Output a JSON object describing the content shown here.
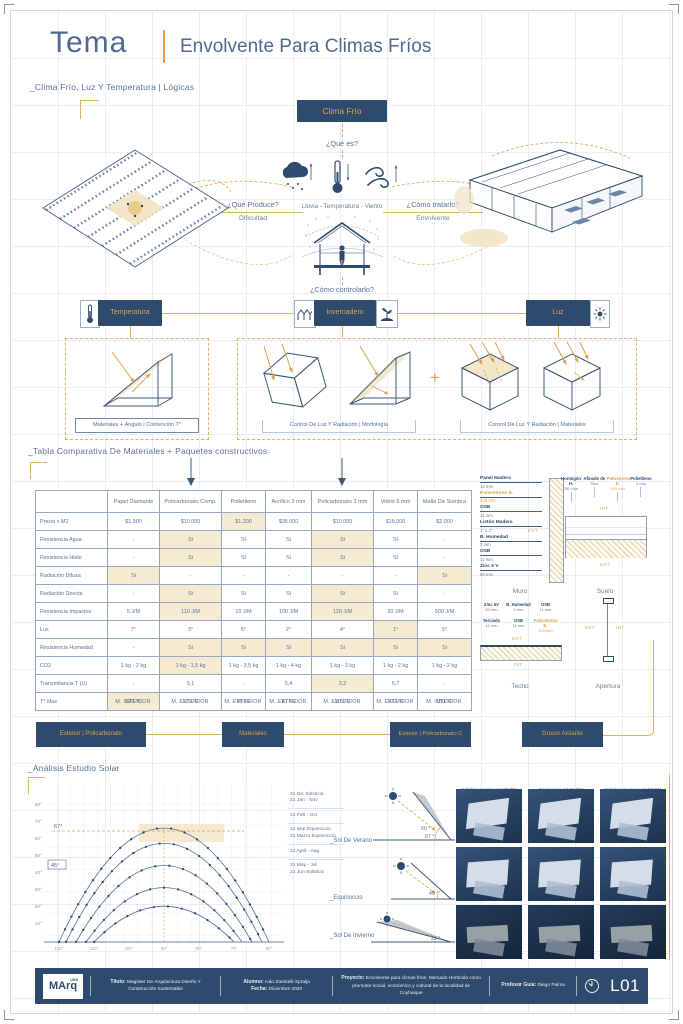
{
  "page": {
    "title_label": "Tema",
    "title": "Envolvente Para Climas Fríos"
  },
  "logic": {
    "section_label": "_Clima Frío, Luz Y Temperatura | Lógicas",
    "root_box": "Clima Frío",
    "q_what": "¿Qué es?",
    "elements_caption": "Lluvia   -   Temperatura   -   Viento",
    "q_produce": "¿Qué Produce?",
    "a_produce": "Dificultad",
    "q_treat": "¿Cómo tratarlo?",
    "a_treat": "Envolvente",
    "q_control": "¿Cómo controlarlo?",
    "control_temperatura": "Temperatura",
    "control_invernadero": "Invernadero",
    "control_luz": "Luz",
    "strategy_1": "Materiales + Ángulo | Contención T°",
    "strategy_2": "Control De Luz Y Radiación | Morfología",
    "strategy_3": "Control De Luz Y Radiación | Materiales",
    "plus": "+"
  },
  "table": {
    "section_label": "_Tabla Comparativa De Materiales + Paquetes constructivos",
    "columns": [
      "",
      "Papel Diamante",
      "Policarbonato Comp.",
      "Polietileno",
      "Acrílico 3 mm",
      "Policarbonato 3 mm",
      "Vidrio 6 mm",
      "Malla De Sombra"
    ],
    "rows": [
      {
        "label": "Precio x M2",
        "values": [
          "$1.500",
          "$10.000",
          "$1.200",
          "$35.000",
          "$10.000",
          "$15.000",
          "$2.000"
        ],
        "hl": [
          2
        ]
      },
      {
        "label": "Resistencia Agua",
        "values": [
          "-",
          "Si",
          "Si",
          "Si",
          "Si",
          "Si",
          "-"
        ],
        "hl": [
          1,
          4
        ]
      },
      {
        "label": "Resistencia Hielo",
        "values": [
          "-",
          "Si",
          "Si",
          "Si",
          "Si",
          "Si",
          "-"
        ],
        "hl": [
          1,
          4
        ]
      },
      {
        "label": "Radiación Difusa",
        "values": [
          "Si",
          "-",
          "-",
          "-",
          "-",
          "-",
          "Si"
        ],
        "hl": [
          0,
          6
        ]
      },
      {
        "label": "Radiación Directa",
        "values": [
          "-",
          "Si",
          "Si",
          "Si",
          "Si",
          "Si",
          "-"
        ],
        "hl": [
          1,
          4
        ]
      },
      {
        "label": "Resistencia Impactos",
        "values": [
          "5 J/M",
          "110 J/M",
          "10 J/M",
          "100 J/M",
          "120 J/M",
          "20 J/M",
          "500 J/M"
        ],
        "hl": [
          1,
          4
        ]
      },
      {
        "label": "Lux",
        "values": [
          "7°",
          "3°",
          "6°",
          "2°",
          "4°",
          "1°",
          "5°"
        ],
        "hl": [
          5
        ]
      },
      {
        "label": "Resistencia Humedad",
        "values": [
          "-",
          "Si",
          "Si",
          "Si",
          "Si",
          "Si",
          "Si"
        ],
        "hl": [
          1,
          2,
          3,
          4,
          5,
          6
        ]
      },
      {
        "label": "CO2",
        "values": [
          "1 kg - 2 kg",
          "1 kg - 1,5 kg",
          "1 kg - 3,5 kg",
          "1 kg - 4 kg",
          "1 kg - 3 kg",
          "1 kg - 2 kg",
          "1 kg - 2 kg"
        ],
        "hl": [
          1
        ]
      },
      {
        "label": "Transmitancia T (U)",
        "values": [
          "-",
          "5,1",
          "-",
          "5,4",
          "3,2",
          "5,7",
          "-"
        ],
        "hl": [
          4
        ]
      },
      {
        "label": "T° Max",
        "values": [
          "220 °C",
          "120 °C",
          "95 °C",
          "87 °C",
          "115 °C",
          "100 °C",
          "150 °C"
        ],
        "hl": [
          0
        ]
      }
    ],
    "m_labels": [
      "M. INTERIOR",
      "M. EXTERIOR",
      "M. EXTERIOR",
      "M. EXTERIOR",
      "M. EXTERIOR",
      "M. EXTERIOR",
      "M. INTERIOR"
    ],
    "button_exterior_1": "Exterior | Policarbonato",
    "button_materiales": "Materiales",
    "button_exterior_2": "Exterior | Policarbonato C",
    "button_grosor": "Grosor Aislante"
  },
  "details": {
    "muro": {
      "title": "Muro",
      "ext": "EXT",
      "int": "INT",
      "layers": [
        {
          "name": "Panel Madera",
          "size": "10 mm",
          "accent": false
        },
        {
          "name": "Poliestireno E.",
          "size": "100 mm",
          "accent": true
        },
        {
          "name": "OSB",
          "size": "11 mm",
          "accent": false
        },
        {
          "name": "Listón Madera",
          "size": "1\" x 2\"",
          "accent": false
        },
        {
          "name": "B. Humedad",
          "size": "2 mm",
          "accent": false
        },
        {
          "name": "OSB",
          "size": "11 mm",
          "accent": false
        },
        {
          "name": "Zinc 5 V",
          "size": "50 mm",
          "accent": false
        }
      ]
    },
    "suelo": {
      "title": "Suelo",
      "int": "INT",
      "ext": "EXT",
      "layers": [
        {
          "name": "Hormigón H.",
          "size": "250 mm",
          "accent": false
        },
        {
          "name": "Afinado de",
          "size": "Piso",
          "accent": false
        },
        {
          "name": "Poliestireno E.",
          "size": "100 mm",
          "accent": true
        },
        {
          "name": "Polietileno",
          "size": "2 mm",
          "accent": false
        }
      ]
    },
    "techo": {
      "title": "Techo",
      "ext": "EXT",
      "int": "INT",
      "layers": [
        {
          "name": "Zinc 5V",
          "size": "50 mm",
          "accent": false
        },
        {
          "name": "B. Humedad",
          "size": "2 mm",
          "accent": false
        },
        {
          "name": "OSB",
          "size": "11 mm",
          "accent": false
        },
        {
          "name": "Terciado",
          "size": "11 mm",
          "accent": false
        },
        {
          "name": "OSB",
          "size": "11 mm",
          "accent": false
        },
        {
          "name": "Poliestireno E.",
          "size": "100 mm",
          "accent": true
        }
      ]
    },
    "apertura": {
      "title": "Apertura",
      "ext": "EXT",
      "int": "INT"
    }
  },
  "solar": {
    "section_label": "_Análisis Estudio Solar",
    "y_ticks": [
      "80°",
      "70°",
      "60°",
      "50°",
      "40°",
      "30°",
      "20°",
      "10°"
    ],
    "x_ticks": [
      "120°",
      "110°",
      "100°",
      "90°",
      "80°",
      "70°",
      "60°"
    ],
    "annotation_67": "67°",
    "annotation_45": "45°",
    "legend": [
      {
        "l1": "21 Dic Solsticio",
        "l2": "21 Jan - Nov"
      },
      {
        "l1": "21 Feb - Oct",
        "l2": ""
      },
      {
        "l1": "21 Sep Equinoccio",
        "l2": "21 Marzo Equinoccio"
      },
      {
        "l1": "21 April - Aug",
        "l2": ""
      },
      {
        "l1": "21 May - Jul",
        "l2": "21 Jun Solsticio"
      }
    ],
    "triangles": [
      {
        "label": "_Sol De Verano",
        "angle_a": "60 °",
        "angle_b": "67 °"
      },
      {
        "label": "_Equinoccio",
        "angle_a": "45 °",
        "angle_b": ""
      },
      {
        "label": "_Sol De Invierno",
        "angle_a": "21 °",
        "angle_b": ""
      }
    ],
    "photo_captions": [
      "Solsticio Verano 12:00 PM",
      "Equinoccio 12:00 PM",
      "Solsticio Invierno 12:00 PM"
    ],
    "chart_data": {
      "type": "line",
      "title": "Carta solar - Análisis Estudio Solar",
      "xlabel": "Azimut",
      "ylabel": "Altitud solar",
      "x_tick_labels": [
        "120°",
        "110°",
        "100°",
        "90°",
        "80°",
        "70°",
        "60°"
      ],
      "y_tick_labels": [
        "80°",
        "70°",
        "60°",
        "50°",
        "40°",
        "30°",
        "20°",
        "10°"
      ],
      "series": [
        {
          "name": "21 Dic Solsticio / 21 Jan - Nov",
          "peak_altitude_deg": 67
        },
        {
          "name": "21 Feb - Oct",
          "peak_altitude_deg": 58
        },
        {
          "name": "21 Sep Equinoccio / 21 Marzo Equinoccio",
          "peak_altitude_deg": 45
        },
        {
          "name": "21 April - Aug",
          "peak_altitude_deg": 32
        },
        {
          "name": "21 May - Jul / 21 Jun Solsticio",
          "peak_altitude_deg": 21
        }
      ],
      "annotations": [
        "67°",
        "45°"
      ],
      "grid": true,
      "legend_position": "right"
    }
  },
  "footer": {
    "logo_text": "MArq",
    "logo_sup": "UDD",
    "titulo_label": "Título:",
    "titulo_value": "Magíster De Arquitectura Diseño Y Construcción Sustentable",
    "alumno_label": "Alumno:",
    "alumno_value": "Iván Zambelli Spralja",
    "fecha_label": "Fecha:",
    "fecha_value": "Diciembre 2020",
    "proyecto_label": "Proyecto:",
    "proyecto_value": "Envolvente para climas fríos. Mercado Hortícola como promotor social, económico y cultural de la localidad de Coyhaique",
    "profesor_label": "Profesor Guía:",
    "profesor_value": "Diego Palma",
    "sheet_code": "L01"
  }
}
